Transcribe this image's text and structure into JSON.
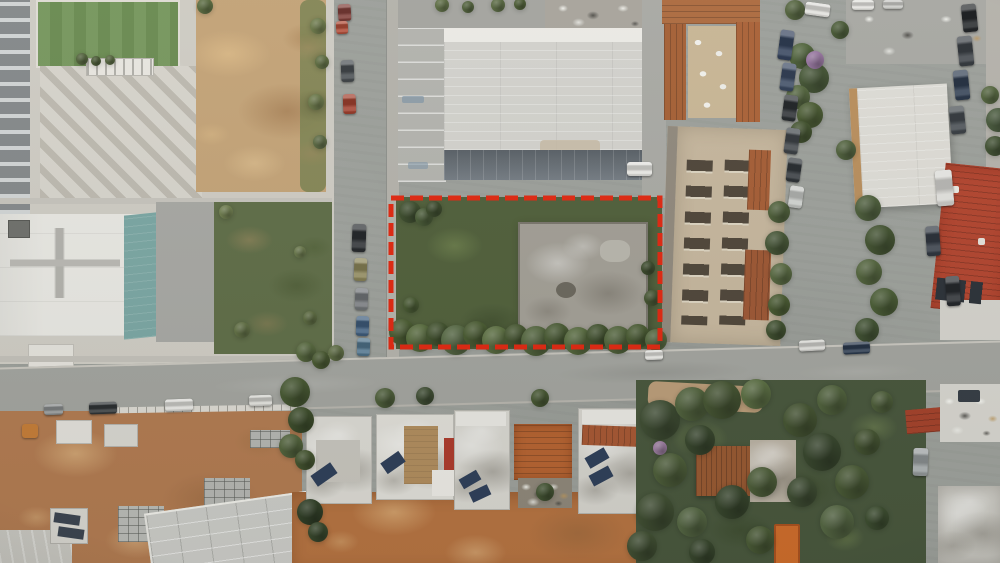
{
  "scene": {
    "type": "aerial-drone-photograph",
    "description": "Top-down aerial photo of an urban block: a vacant grassy land plot with a derelict grey flat-roofed building, highlighted by a red dashed boundary line; surrounded by streets with parked cars, a large warehouse with lined roof to the north, a schoolyard and turf field to the north-west, terracotta-roofed buildings to the east, a row of houses with solar panels to the south, an earth-moving construction site to the south-west and dense tree cover to the south-east.",
    "annotation_purpose": "real-estate land plot boundary highlight"
  },
  "annotation": {
    "shape": "dashed-rectangle",
    "x": 391,
    "y": 198,
    "width": 269,
    "height": 149,
    "stroke": "#e1250e",
    "stroke_width": 5,
    "dash": "13 6"
  },
  "palette": {
    "boundary_red": "#e1250e",
    "street_grey": "#9da09b",
    "plot_grass": "#4f5e39",
    "turf_green": "#6f9154",
    "dirt_tan": "#c4a377",
    "construction_dirt": "#b1794f",
    "terracotta": "#ad6a3e",
    "big_red_roof": "#b2432d",
    "teal_roof": "#7aa6a3",
    "warehouse_roof": "#d3d2cd",
    "tree_green": "#46543a"
  },
  "objects": {
    "cars": [
      {
        "name": "car-maroon-left-street",
        "x": 338,
        "y": 4,
        "w": 13,
        "h": 17,
        "color": "#7b3530",
        "rot": -3
      },
      {
        "name": "car-red-small-left-street",
        "x": 336,
        "y": 21,
        "w": 12,
        "h": 13,
        "color": "#b0452f",
        "rot": -3
      },
      {
        "name": "car-darkgrey-left-street",
        "x": 341,
        "y": 60,
        "w": 13,
        "h": 22,
        "color": "#41464a",
        "rot": -2
      },
      {
        "name": "car-red-left-street",
        "x": 343,
        "y": 94,
        "w": 13,
        "h": 20,
        "color": "#a23a28",
        "rot": -2
      },
      {
        "name": "car-black-left-street",
        "x": 352,
        "y": 224,
        "w": 14,
        "h": 28,
        "color": "#25282c",
        "rot": 2
      },
      {
        "name": "car-olive-left-street",
        "x": 354,
        "y": 258,
        "w": 13,
        "h": 23,
        "color": "#8e8657",
        "rot": 2
      },
      {
        "name": "car-grey-left-street",
        "x": 355,
        "y": 288,
        "w": 13,
        "h": 22,
        "color": "#74777b",
        "rot": 2
      },
      {
        "name": "car-blue-left-street",
        "x": 356,
        "y": 316,
        "w": 13,
        "h": 20,
        "color": "#3d5d80",
        "rot": 2
      },
      {
        "name": "car-steelblue-left-street",
        "x": 357,
        "y": 338,
        "w": 13,
        "h": 18,
        "color": "#4f7590",
        "rot": 2
      },
      {
        "name": "van-grey-main-road",
        "x": 44,
        "y": 404,
        "w": 19,
        "h": 11,
        "color": "#8e9192",
        "rot": -2
      },
      {
        "name": "suv-dark-main-road",
        "x": 89,
        "y": 402,
        "w": 28,
        "h": 12,
        "color": "#2f3336",
        "rot": -2
      },
      {
        "name": "pickup-white-main-road",
        "x": 165,
        "y": 399,
        "w": 28,
        "h": 12,
        "color": "#e4e3df",
        "rot": -2
      },
      {
        "name": "van-white-main-road",
        "x": 249,
        "y": 395,
        "w": 23,
        "h": 11,
        "color": "#dddcd7",
        "rot": -2
      },
      {
        "name": "car-white-main-road-center",
        "x": 645,
        "y": 350,
        "w": 18,
        "h": 10,
        "color": "#e6e5e1",
        "rot": -2
      },
      {
        "name": "car-white-main-road-right",
        "x": 799,
        "y": 340,
        "w": 26,
        "h": 11,
        "color": "#dcdbd7",
        "rot": -3
      },
      {
        "name": "car-darkblue-main-road-right",
        "x": 843,
        "y": 342,
        "w": 27,
        "h": 12,
        "color": "#27364c",
        "rot": -3
      },
      {
        "name": "van-white-plot-corner",
        "x": 627,
        "y": 162,
        "w": 25,
        "h": 14,
        "color": "#e7e6e2",
        "rot": 0
      },
      {
        "name": "van-white-topright",
        "x": 805,
        "y": 3,
        "w": 25,
        "h": 13,
        "color": "#e2e1dd",
        "rot": 8
      },
      {
        "name": "car-blue-east-street-1",
        "x": 779,
        "y": 30,
        "w": 14,
        "h": 30,
        "color": "#2b3a55",
        "rot": 8
      },
      {
        "name": "car-blue-east-street-2",
        "x": 781,
        "y": 63,
        "w": 14,
        "h": 28,
        "color": "#33425c",
        "rot": 8
      },
      {
        "name": "car-black-east-street",
        "x": 783,
        "y": 95,
        "w": 14,
        "h": 26,
        "color": "#23272b",
        "rot": 8
      },
      {
        "name": "car-grey-east-street",
        "x": 785,
        "y": 128,
        "w": 14,
        "h": 26,
        "color": "#3a3f44",
        "rot": 8
      },
      {
        "name": "car-dark-east-street",
        "x": 787,
        "y": 158,
        "w": 14,
        "h": 24,
        "color": "#2c3136",
        "rot": 8
      },
      {
        "name": "car-light-east-street",
        "x": 789,
        "y": 186,
        "w": 14,
        "h": 22,
        "color": "#caccc9",
        "rot": 8
      },
      {
        "name": "car-black-right-street-1",
        "x": 962,
        "y": 4,
        "w": 15,
        "h": 28,
        "color": "#1b1e21",
        "rot": -6
      },
      {
        "name": "car-grey-right-street-2",
        "x": 958,
        "y": 36,
        "w": 15,
        "h": 30,
        "color": "#34393f",
        "rot": -6
      },
      {
        "name": "car-blue-right-street-3",
        "x": 954,
        "y": 70,
        "w": 15,
        "h": 30,
        "color": "#27354a",
        "rot": -6
      },
      {
        "name": "car-grey-right-street-4",
        "x": 950,
        "y": 106,
        "w": 15,
        "h": 28,
        "color": "#3c4248",
        "rot": -6
      },
      {
        "name": "van-white-right-street",
        "x": 936,
        "y": 170,
        "w": 17,
        "h": 36,
        "color": "#dddcd8",
        "rot": -5
      },
      {
        "name": "car-dark-right-street-5",
        "x": 926,
        "y": 226,
        "w": 14,
        "h": 30,
        "color": "#2e3540",
        "rot": -4
      },
      {
        "name": "car-black-right-street-6",
        "x": 946,
        "y": 276,
        "w": 14,
        "h": 30,
        "color": "#23262b",
        "rot": -4
      },
      {
        "name": "car-silver-right-street-bottom",
        "x": 913,
        "y": 448,
        "w": 15,
        "h": 28,
        "color": "#9fa4a6",
        "rot": 2
      },
      {
        "name": "car-white-top-edge-1",
        "x": 852,
        "y": 0,
        "w": 22,
        "h": 10,
        "color": "#e3e2de",
        "rot": 0
      },
      {
        "name": "car-grey-top-edge-2",
        "x": 883,
        "y": 0,
        "w": 20,
        "h": 9,
        "color": "#c9c9c5",
        "rot": 0
      }
    ],
    "trees": [
      {
        "x": 402,
        "y": 332,
        "r": 13,
        "color": "#48592f"
      },
      {
        "x": 420,
        "y": 338,
        "r": 14,
        "color": "#55683a"
      },
      {
        "x": 438,
        "y": 334,
        "r": 12,
        "color": "#3f4f2b"
      },
      {
        "x": 456,
        "y": 340,
        "r": 15,
        "color": "#536540"
      },
      {
        "x": 476,
        "y": 334,
        "r": 13,
        "color": "#47582f"
      },
      {
        "x": 496,
        "y": 340,
        "r": 14,
        "color": "#5a6d3f"
      },
      {
        "x": 516,
        "y": 336,
        "r": 12,
        "color": "#44542e"
      },
      {
        "x": 536,
        "y": 341,
        "r": 15,
        "color": "#50623a"
      },
      {
        "x": 557,
        "y": 336,
        "r": 13,
        "color": "#465730"
      },
      {
        "x": 578,
        "y": 341,
        "r": 14,
        "color": "#55683c"
      },
      {
        "x": 598,
        "y": 336,
        "r": 12,
        "color": "#3f4f2b"
      },
      {
        "x": 618,
        "y": 340,
        "r": 14,
        "color": "#4f6138"
      },
      {
        "x": 638,
        "y": 336,
        "r": 12,
        "color": "#46572f"
      },
      {
        "x": 656,
        "y": 340,
        "r": 11,
        "color": "#52643c"
      },
      {
        "x": 410,
        "y": 212,
        "r": 11,
        "color": "#3c4c2c"
      },
      {
        "x": 424,
        "y": 217,
        "r": 9,
        "color": "#475934"
      },
      {
        "x": 434,
        "y": 209,
        "r": 8,
        "color": "#394829"
      },
      {
        "x": 411,
        "y": 305,
        "r": 8,
        "color": "#45562f"
      },
      {
        "x": 652,
        "y": 298,
        "r": 8,
        "color": "#42512e"
      },
      {
        "x": 648,
        "y": 268,
        "r": 7,
        "color": "#394729"
      },
      {
        "x": 802,
        "y": 56,
        "r": 13,
        "color": "#4d6138"
      },
      {
        "x": 814,
        "y": 78,
        "r": 15,
        "color": "#435433"
      },
      {
        "x": 798,
        "y": 97,
        "r": 12,
        "color": "#52643c"
      },
      {
        "x": 810,
        "y": 115,
        "r": 13,
        "color": "#47582f"
      },
      {
        "x": 801,
        "y": 132,
        "r": 11,
        "color": "#3f4f2b"
      },
      {
        "x": 815,
        "y": 60,
        "r": 9,
        "color": "#95739e"
      },
      {
        "x": 779,
        "y": 212,
        "r": 11,
        "color": "#4c5d37"
      },
      {
        "x": 777,
        "y": 243,
        "r": 12,
        "color": "#435333"
      },
      {
        "x": 781,
        "y": 274,
        "r": 11,
        "color": "#55663e"
      },
      {
        "x": 779,
        "y": 305,
        "r": 11,
        "color": "#47582f"
      },
      {
        "x": 776,
        "y": 330,
        "r": 10,
        "color": "#3d4d2c"
      },
      {
        "x": 846,
        "y": 150,
        "r": 10,
        "color": "#4e5f3a"
      },
      {
        "x": 868,
        "y": 208,
        "r": 13,
        "color": "#4b5c39"
      },
      {
        "x": 880,
        "y": 240,
        "r": 15,
        "color": "#41512f"
      },
      {
        "x": 869,
        "y": 272,
        "r": 13,
        "color": "#52633c"
      },
      {
        "x": 884,
        "y": 302,
        "r": 14,
        "color": "#485a33"
      },
      {
        "x": 867,
        "y": 330,
        "r": 12,
        "color": "#3f5030"
      },
      {
        "x": 795,
        "y": 10,
        "r": 10,
        "color": "#50603a"
      },
      {
        "x": 840,
        "y": 30,
        "r": 9,
        "color": "#455632"
      },
      {
        "x": 998,
        "y": 120,
        "r": 12,
        "color": "#46573a"
      },
      {
        "x": 995,
        "y": 146,
        "r": 10,
        "color": "#3e4e2f"
      },
      {
        "x": 990,
        "y": 95,
        "r": 9,
        "color": "#51623b"
      },
      {
        "x": 442,
        "y": 5,
        "r": 7,
        "color": "#5a6a40"
      },
      {
        "x": 468,
        "y": 7,
        "r": 6,
        "color": "#4c5c36"
      },
      {
        "x": 498,
        "y": 5,
        "r": 7,
        "color": "#56663e"
      },
      {
        "x": 520,
        "y": 4,
        "r": 6,
        "color": "#47572f"
      },
      {
        "x": 318,
        "y": 26,
        "r": 8,
        "color": "#6a7747"
      },
      {
        "x": 322,
        "y": 62,
        "r": 7,
        "color": "#5c6a3e"
      },
      {
        "x": 316,
        "y": 102,
        "r": 8,
        "color": "#687546"
      },
      {
        "x": 320,
        "y": 142,
        "r": 7,
        "color": "#596740"
      },
      {
        "x": 205,
        "y": 6,
        "r": 8,
        "color": "#57683c"
      },
      {
        "x": 82,
        "y": 59,
        "r": 6,
        "color": "#4f5f38"
      },
      {
        "x": 96,
        "y": 61,
        "r": 5,
        "color": "#44542f"
      },
      {
        "x": 110,
        "y": 60,
        "r": 5,
        "color": "#52623a"
      },
      {
        "x": 226,
        "y": 212,
        "r": 7,
        "color": "#6d7b4c"
      },
      {
        "x": 242,
        "y": 330,
        "r": 8,
        "color": "#5f6d42"
      },
      {
        "x": 300,
        "y": 252,
        "r": 6,
        "color": "#68764a"
      },
      {
        "x": 310,
        "y": 318,
        "r": 7,
        "color": "#5a683e"
      },
      {
        "x": 306,
        "y": 352,
        "r": 10,
        "color": "#55663c"
      },
      {
        "x": 321,
        "y": 360,
        "r": 9,
        "color": "#47572f"
      },
      {
        "x": 336,
        "y": 353,
        "r": 8,
        "color": "#5d6b42"
      },
      {
        "x": 295,
        "y": 392,
        "r": 15,
        "color": "#44552f"
      },
      {
        "x": 301,
        "y": 420,
        "r": 13,
        "color": "#3a4a28"
      },
      {
        "x": 291,
        "y": 446,
        "r": 12,
        "color": "#50613a"
      },
      {
        "x": 305,
        "y": 460,
        "r": 10,
        "color": "#42522d"
      },
      {
        "x": 385,
        "y": 398,
        "r": 10,
        "color": "#4b5b37"
      },
      {
        "x": 425,
        "y": 396,
        "r": 9,
        "color": "#3c4a30"
      },
      {
        "x": 540,
        "y": 398,
        "r": 9,
        "color": "#44542f"
      },
      {
        "x": 545,
        "y": 492,
        "r": 9,
        "color": "#415130"
      },
      {
        "x": 660,
        "y": 420,
        "r": 20,
        "color": "#3c4a30"
      },
      {
        "x": 692,
        "y": 404,
        "r": 17,
        "color": "#4e5f3a"
      },
      {
        "x": 722,
        "y": 400,
        "r": 19,
        "color": "#42512f"
      },
      {
        "x": 756,
        "y": 394,
        "r": 15,
        "color": "#586b40"
      },
      {
        "x": 700,
        "y": 440,
        "r": 15,
        "color": "#35432a"
      },
      {
        "x": 670,
        "y": 470,
        "r": 17,
        "color": "#4b5b37"
      },
      {
        "x": 655,
        "y": 512,
        "r": 19,
        "color": "#3e4c30"
      },
      {
        "x": 692,
        "y": 522,
        "r": 15,
        "color": "#526340"
      },
      {
        "x": 732,
        "y": 502,
        "r": 17,
        "color": "#35432a"
      },
      {
        "x": 762,
        "y": 482,
        "r": 15,
        "color": "#4b5b37"
      },
      {
        "x": 800,
        "y": 420,
        "r": 17,
        "color": "#42512f"
      },
      {
        "x": 832,
        "y": 400,
        "r": 15,
        "color": "#4e5f3a"
      },
      {
        "x": 822,
        "y": 452,
        "r": 19,
        "color": "#35432a"
      },
      {
        "x": 852,
        "y": 482,
        "r": 17,
        "color": "#475733"
      },
      {
        "x": 802,
        "y": 492,
        "r": 15,
        "color": "#3c4a30"
      },
      {
        "x": 837,
        "y": 522,
        "r": 17,
        "color": "#526340"
      },
      {
        "x": 867,
        "y": 442,
        "r": 13,
        "color": "#42512f"
      },
      {
        "x": 882,
        "y": 402,
        "r": 11,
        "color": "#4b5b37"
      },
      {
        "x": 642,
        "y": 546,
        "r": 15,
        "color": "#3e4c30"
      },
      {
        "x": 702,
        "y": 552,
        "r": 13,
        "color": "#35432a"
      },
      {
        "x": 760,
        "y": 540,
        "r": 14,
        "color": "#475733"
      },
      {
        "x": 877,
        "y": 518,
        "r": 12,
        "color": "#3a4a2d"
      },
      {
        "x": 660,
        "y": 448,
        "r": 7,
        "color": "#9a7a9e"
      },
      {
        "x": 310,
        "y": 512,
        "r": 13,
        "color": "#2f3d25"
      },
      {
        "x": 318,
        "y": 532,
        "r": 10,
        "color": "#36452a"
      }
    ]
  }
}
